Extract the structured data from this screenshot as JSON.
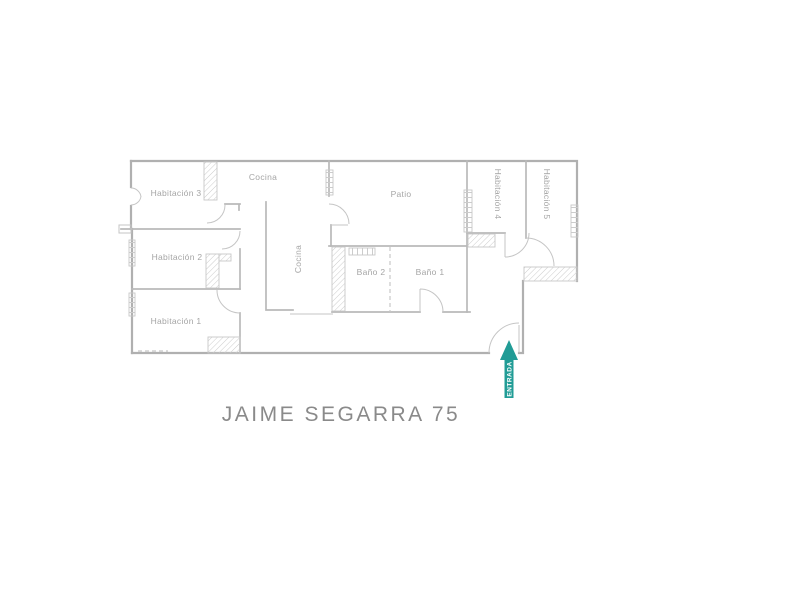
{
  "title": "JAIME SEGARRA 75",
  "entrance": {
    "label": "ENTRADA",
    "arrow_direction": "up"
  },
  "colors": {
    "walls": "#b0b0b0",
    "hatch": "#c8c8c8",
    "labels": "#a5a5a5",
    "title": "#8a8a8a",
    "accent_teal": "#219c96",
    "background": "#ffffff"
  },
  "rooms": [
    {
      "id": "habitacion3",
      "label": "Habitación 3",
      "orientation": "horizontal"
    },
    {
      "id": "habitacion2",
      "label": "Habitación 2",
      "orientation": "horizontal"
    },
    {
      "id": "habitacion1",
      "label": "Habitación 1",
      "orientation": "horizontal"
    },
    {
      "id": "cocina",
      "label": "Cocina",
      "orientation": "horizontal"
    },
    {
      "id": "cocina-pasillo",
      "label": "Cocina",
      "orientation": "vertical"
    },
    {
      "id": "patio",
      "label": "Patio",
      "orientation": "horizontal"
    },
    {
      "id": "habitacion4",
      "label": "Habitación 4",
      "orientation": "vertical"
    },
    {
      "id": "habitacion5",
      "label": "Habitación 5",
      "orientation": "vertical"
    },
    {
      "id": "bano2",
      "label": "Baño 2",
      "orientation": "horizontal"
    },
    {
      "id": "bano1",
      "label": "Baño 1",
      "orientation": "horizontal"
    }
  ]
}
